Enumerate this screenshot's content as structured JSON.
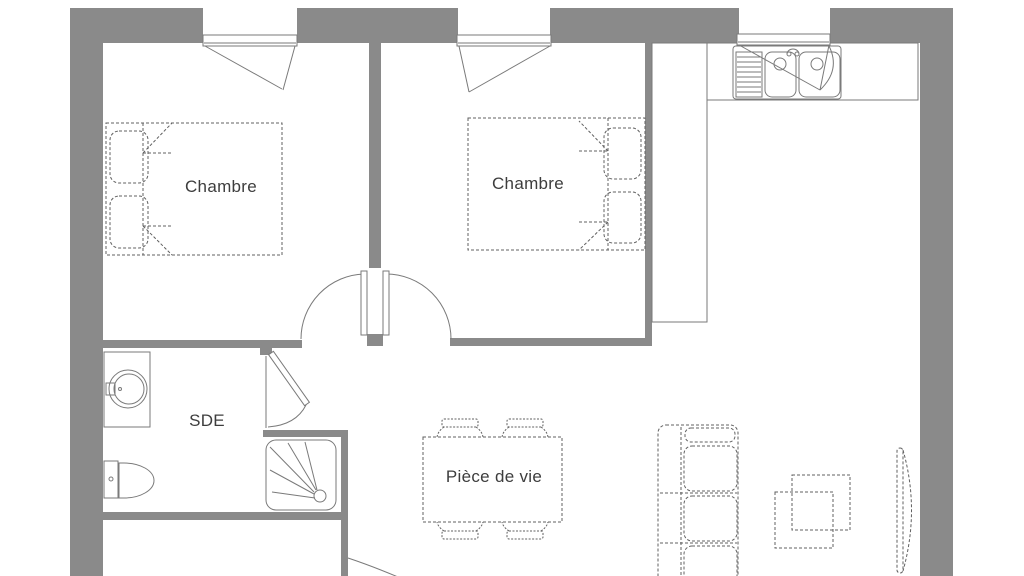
{
  "plan": {
    "title": "Apartment floor plan",
    "rooms": [
      {
        "id": "bedroom-1",
        "label": "Chambre"
      },
      {
        "id": "bedroom-2",
        "label": "Chambre"
      },
      {
        "id": "shower-room",
        "label": "SDE"
      },
      {
        "id": "living-room",
        "label": "Pièce de vie"
      }
    ],
    "colors": {
      "wall": "#8a8a8a",
      "fixture_line": "#7a7a7a",
      "furniture_line": "#606060",
      "label_text": "#3d3d3d",
      "background": "#ffffff"
    }
  }
}
